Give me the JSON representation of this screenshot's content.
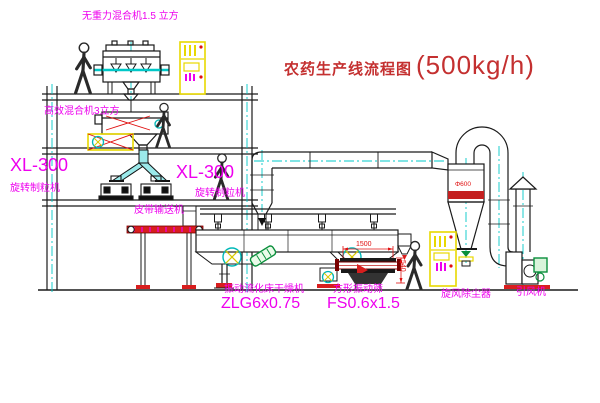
{
  "diagram": {
    "title": {
      "text_cn": "农药生产线流程图",
      "capacity": "(500kg/h)"
    },
    "labels": {
      "gravity_mixer": "无重力混合机1.5 立方",
      "high_eff_mixer": "高效混合机3立方",
      "granulator_left_model": "XL-300",
      "granulator_left_name": "旋转制粒机",
      "granulator_mid_model": "XL-300",
      "granulator_mid_name": "旋转制粒机",
      "belt_conveyor": "皮带输送机",
      "dryer_name": "振动流化床干燥机",
      "dryer_model": "ZLG6x0.75",
      "sieve_name": "方形振动筛",
      "sieve_model": "FS0.6x1.5",
      "cyclone": "旋风除尘器",
      "fan": "引风机"
    },
    "dimensions": {
      "sieve_length": "1500",
      "sieve_height": "540",
      "cyclone_note": "Φ600"
    },
    "colors": {
      "label_magenta": "#ee00ee",
      "title_red": "#c43030",
      "dimension_red": "#e01010",
      "centerline_cyan": "#00c8c8",
      "cabinet_yellow": "#e8d800",
      "machine_black": "#1a1a1a",
      "motor_green": "#0a8f3c",
      "conveyor_red": "#d81e1e"
    }
  }
}
